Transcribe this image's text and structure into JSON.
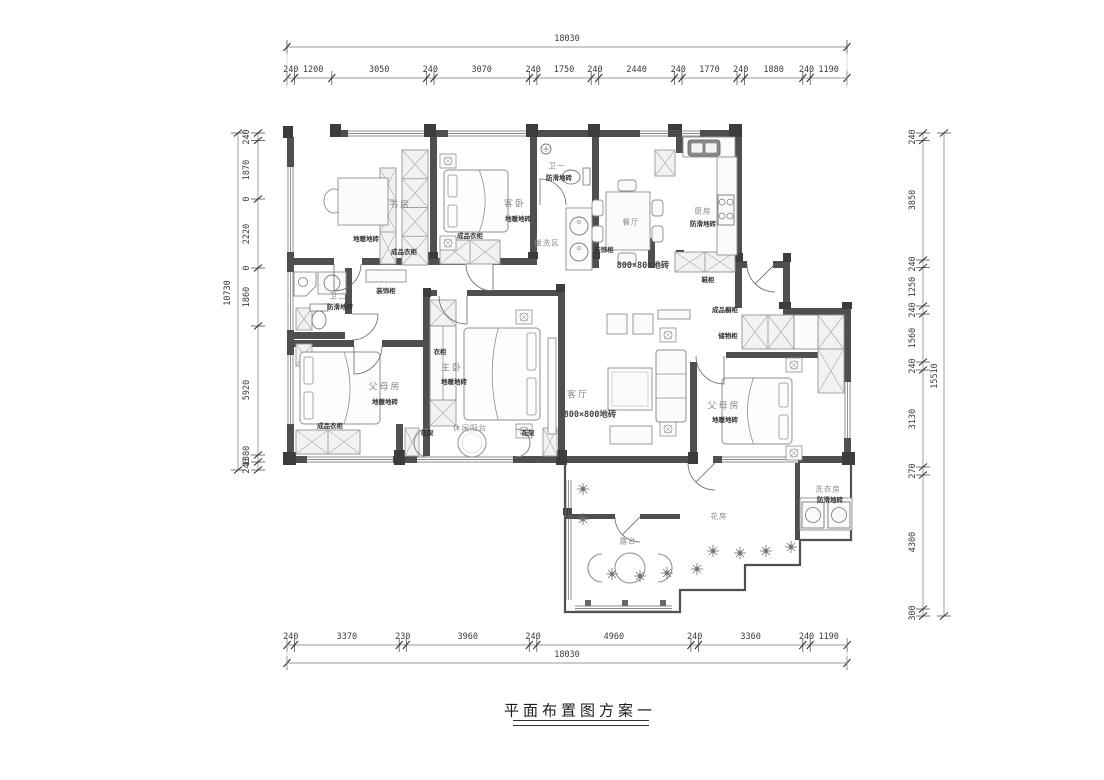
{
  "title": {
    "text": "平面布置图方案一"
  },
  "dims": {
    "top": {
      "total": "18030",
      "segments": [
        "240",
        "1200",
        "3050",
        "240",
        "3070",
        "240",
        "1750",
        "240",
        "2440",
        "240",
        "1770",
        "240",
        "1880",
        "240",
        "1190"
      ]
    },
    "bottom": {
      "total": "18030",
      "segments": [
        "240",
        "3370",
        "230",
        "3960",
        "240",
        "4960",
        "240",
        "3360",
        "240",
        "1190"
      ]
    },
    "left": {
      "total": "10730",
      "segments": [
        "240",
        "1870",
        "0",
        "2220",
        "0",
        "1860",
        "5920",
        "1380",
        "240"
      ]
    },
    "right": {
      "total": "15510",
      "segments": [
        "240",
        "3850",
        "240",
        "1250",
        "240",
        "1560",
        "240",
        "3130",
        "270",
        "4300",
        "300"
      ]
    }
  },
  "labels": {
    "study": "书房",
    "study_finish": "地暖地砖",
    "study_wardrobe": "成品衣柜",
    "guest": "客卧",
    "guest_finish": "地暖地砖",
    "guest_wardrobe": "成品衣柜",
    "bath1": "卫一",
    "bath1_finish": "防滑地砖",
    "wash_area": "盥洗区",
    "deco_cabinet_hall": "装饰柜",
    "dining": "餐厅",
    "dining_tile": "800×800地砖",
    "kitchen": "厨房",
    "kitchen_finish": "防滑地砖",
    "shoe_cabinet": "鞋柜",
    "bath2": "卫二",
    "bath2_finish": "防滑地砖",
    "deco_cabinet_corridor": "装饰柜",
    "parents_left": "父母房",
    "parents_left_finish": "地暖地砖",
    "parents_left_wardrobe": "成品衣柜",
    "master": "主卧",
    "master_finish": "地暖地砖",
    "master_closet": "衣柜",
    "balcony": "休闲阳台",
    "flower_stand_left": "花架",
    "flower_stand_right": "花架",
    "living": "客厅",
    "living_tile": "800×800地砖",
    "cabinet_ready": "成品橱柜",
    "storage_cabinet": "储物柜",
    "parents_right": "父母房",
    "parents_right_finish": "地暖地砖",
    "flower_room": "花房",
    "terrace": "露台",
    "laundry": "洗衣房",
    "laundry_finish": "防滑地砖"
  },
  "colors": {
    "wall": "#4f4f4f",
    "furniture_line": "#8f8f8f",
    "dim_line": "#777777",
    "text": "#3a3a3a"
  }
}
